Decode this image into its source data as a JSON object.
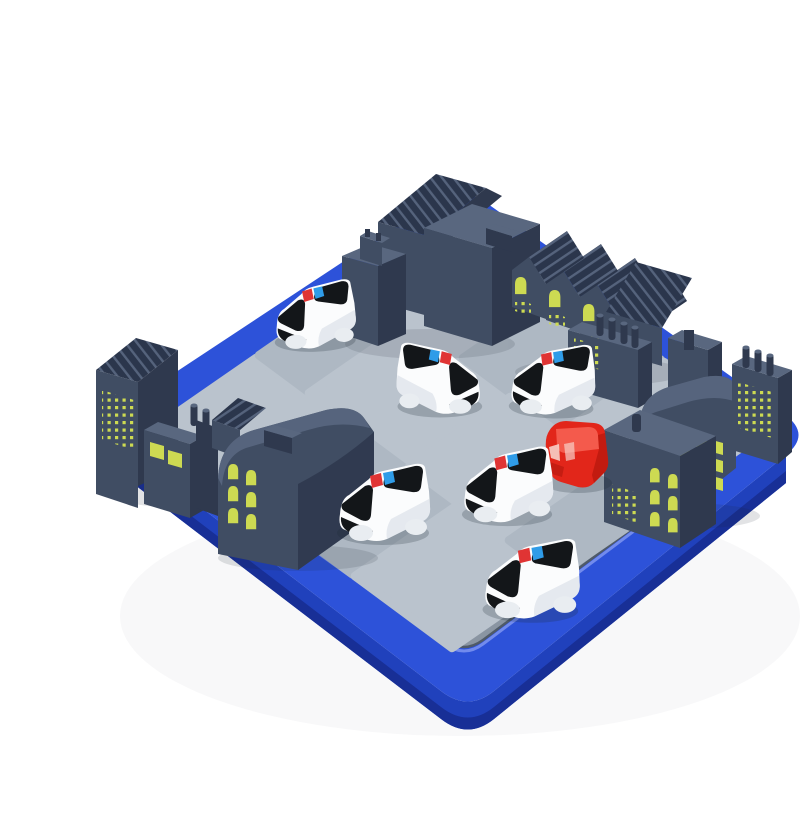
{
  "scene": {
    "type": "product photo",
    "subject": "Road-block logic puzzle board game: blue tray with gray road tiles, six white police cars surrounding one red car, dark city buildings with lit yellow windows around the edges",
    "background": "#ffffff"
  },
  "board": {
    "tray": "square blue plastic tray, rounded corners, viewed at 3/4 angle",
    "floor": "light gray interlocking road puzzle tiles",
    "grid_estimate": "6x6"
  },
  "pieces": {
    "police_cars": {
      "count": 6,
      "body_color": "white",
      "windshield": "black",
      "light_bar": [
        "red",
        "blue"
      ]
    },
    "red_car": {
      "count": 1,
      "body_color": "red"
    },
    "buildings": {
      "clusters": 6,
      "style": "dark slate towers, row houses and factories",
      "window_color": "#cdda52"
    },
    "tiles": {
      "color": "#bac3cd"
    }
  },
  "colors": {
    "bg": "#ffffff",
    "tray_top": "#2d52d9",
    "tray_side": "#2041bc",
    "tray_deep": "#182f96",
    "tray_lip": "#7f95f0",
    "floor_base": "#8a95a2",
    "floor_groove": "#4f5a68",
    "tile": "#bac3cd",
    "tile_alt": "#aeb8c3",
    "tile_edge": "#9aa4b0",
    "bld": "#404d63",
    "bld_dark": "#2f394e",
    "bld_top": "#59677f",
    "roof": "#2b364c",
    "roof_line": "#55637c",
    "window": "#cdda52",
    "car_white": "#fbfcfd",
    "car_shade": "#dde3e9",
    "glass": "#131619",
    "light_red": "#e03434",
    "light_blue": "#2f9ce8",
    "wheel": "#e9edf1",
    "red_car": "#e2261a",
    "red_car_light": "#f45a4c",
    "red_car_win": "#f7cfc8",
    "red_car_dark": "#a81309",
    "shadow": "#1c2733"
  }
}
